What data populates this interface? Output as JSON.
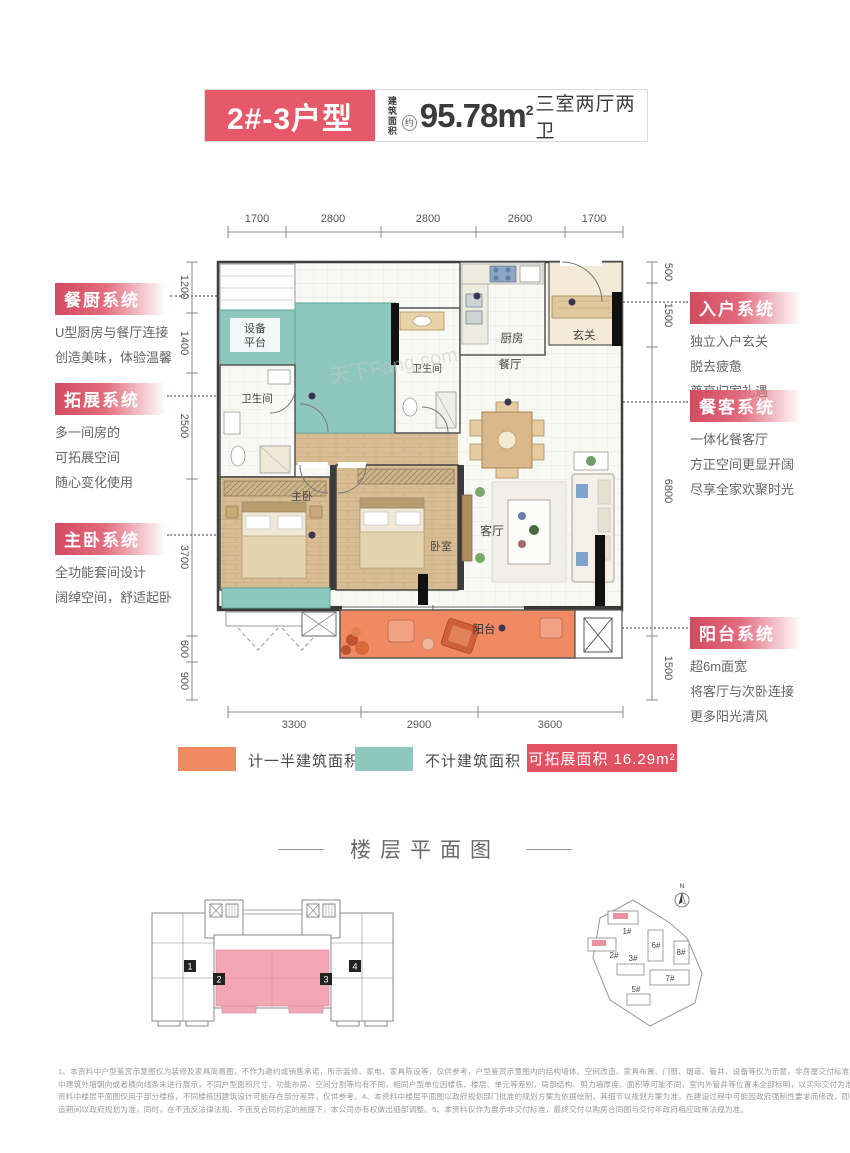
{
  "header": {
    "unit_title": "2#-3户型",
    "area_label_line1": "建筑",
    "area_label_line2": "面积",
    "area_approx": "约",
    "area_value": "95.78m",
    "area_sup": "2",
    "layout_desc": "三室两厅两卫"
  },
  "plan": {
    "dims_top": [
      "1700",
      "2800",
      "2800",
      "2600",
      "1700"
    ],
    "dims_bottom": [
      "3300",
      "2900",
      "3600"
    ],
    "dims_left": [
      "1200",
      "1400",
      "2500",
      "3700",
      "600",
      "900"
    ],
    "dims_right": [
      "500",
      "1500",
      "6800",
      "1500"
    ],
    "rooms": {
      "equipment_l1": "设备",
      "equipment_l2": "平台",
      "bath1": "卫生间",
      "bath2": "卫生间",
      "kitchen": "厨房",
      "foyer": "玄关",
      "dining": "餐厅",
      "master": "主卧",
      "bedroom": "卧室",
      "living": "客厅",
      "balcony": "阳台"
    },
    "watermark": "天下Fang.com"
  },
  "annotations": {
    "left": [
      {
        "title": "餐厨系统",
        "lines": [
          "U型厨房与餐厅连接",
          "创造美味，体验温馨"
        ]
      },
      {
        "title": "拓展系统",
        "lines": [
          "多一间房的",
          "可拓展空间",
          "随心变化使用"
        ]
      },
      {
        "title": "主卧系统",
        "lines": [
          "全功能套间设计",
          "阔绰空间，舒适起卧"
        ]
      }
    ],
    "right": [
      {
        "title": "入户系统",
        "lines": [
          "独立入户玄关",
          "脱去疲惫",
          "尊享归家礼遇"
        ]
      },
      {
        "title": "餐客系统",
        "lines": [
          "一体化餐客厅",
          "方正空间更显开阔",
          "尽享全家欢聚时光"
        ]
      },
      {
        "title": "阳台系统",
        "lines": [
          "超6m面宽",
          "将客厅与次卧连接",
          "更多阳光清风"
        ]
      }
    ]
  },
  "legend": {
    "half_area": "计一半建筑面积",
    "excluded_area": "不计建筑面积",
    "expandable": "可拓展面积 16.29m²"
  },
  "floor_section": {
    "title": "楼层平面图",
    "units": [
      "1",
      "2",
      "3",
      "4"
    ]
  },
  "site_plan": {
    "buildings": [
      "1#",
      "2#",
      "3#",
      "5#",
      "6#",
      "7#",
      "8#"
    ],
    "north": "N"
  },
  "disclaimer": {
    "lines": [
      "1、本资料中户型鉴赏示意图仅为装修及家具简易图，不作为邀约或销售承诺，所示装修、家电、家具陈设等，仅供参考，户型鉴赏示意图内的结构墙体、空间改造、家具布置、门窗、烟道、管井、设备等仅为示意，非房屋交付标准。2、本资料",
      "中建筑外墙朝向或者横向线条未进行展示，不同户型面积尺寸、功能布局、空间分割等均有不同，相同户型单位因楼栋、楼层、单元等差别，局部结构、剪力墙厚度、面积等可能不同，室内外管井等位置未全部标明，以实际交付为准。3、本",
      "资料中楼层平面图仅用于部分楼栋，不同楼栋因建筑设计可能存在部分差异，仅供参考。4、本资料中楼层平面图以政府规划部门批准的规划方案为依据绘制，其细节以规划方案为准，在建设过程中可能因政府强制性要求而修改，即改",
      "造期间以政府规划为准，同时，在不违反法律法规、不违反合同约定的前提下，本公司亦有权做出细部调整。5、本资料仅作为展示非交付标准，最终交付以购房合同图与交付年政府相应政策法规为准。"
    ]
  },
  "colors": {
    "accent_red": "#e5596b",
    "legend_red": "#e25261",
    "teal": "#8ec7bd",
    "orange": "#ef8a62",
    "highlight_pink": "#f3a7b4"
  }
}
